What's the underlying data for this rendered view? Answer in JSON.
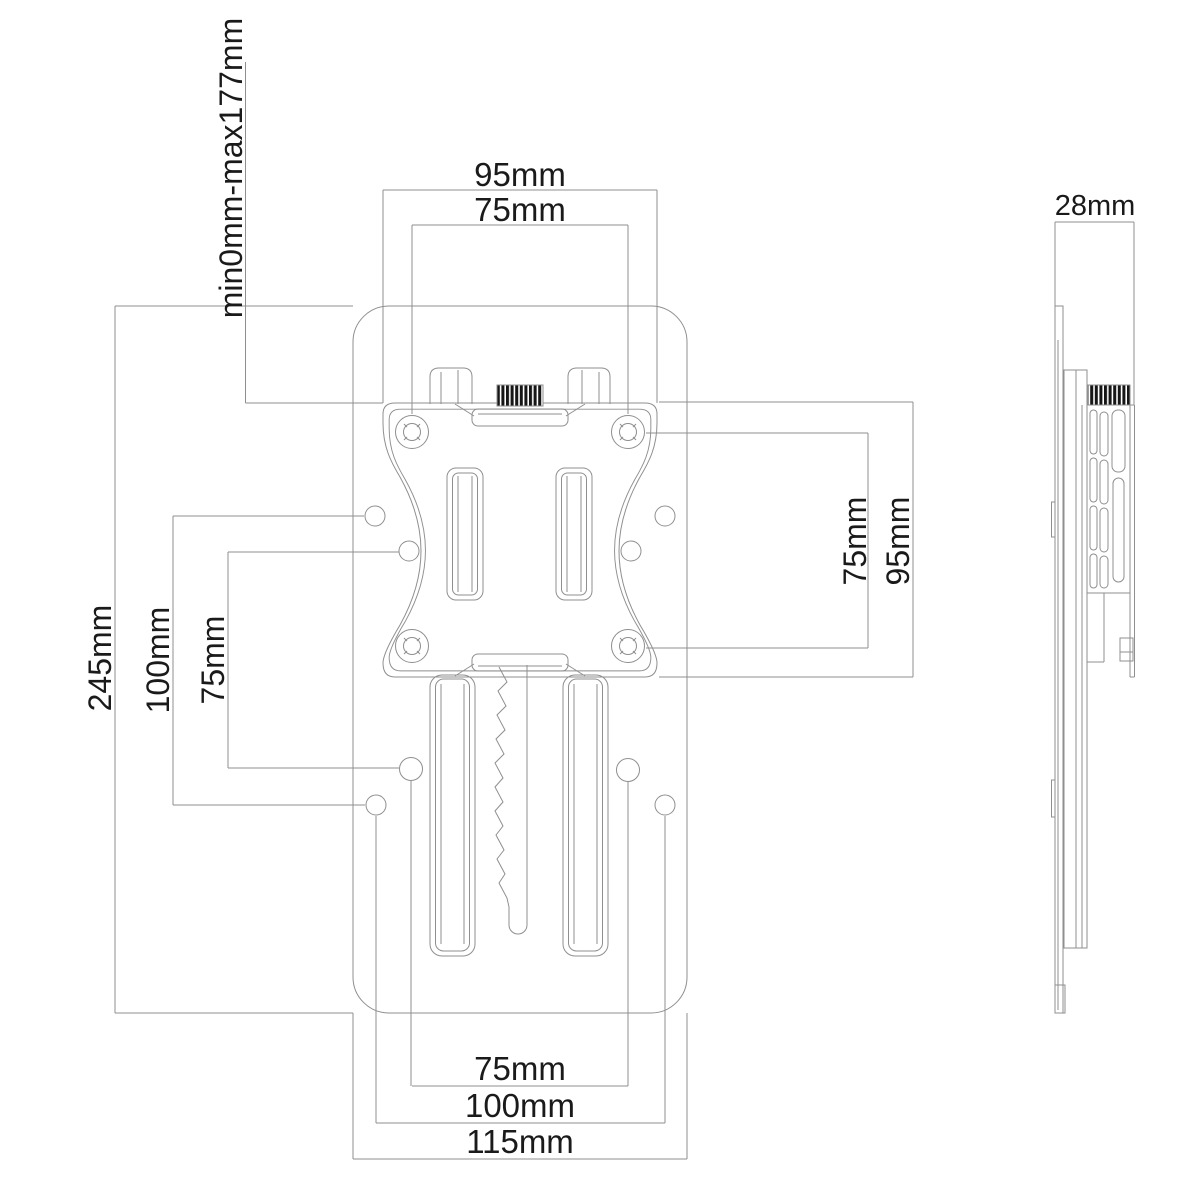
{
  "drawing": {
    "labels": {
      "top_outer": "95mm",
      "top_inner": "75mm",
      "travel_range": "min0mm-max177mm",
      "left_outer": "245mm",
      "left_mid": "100mm",
      "left_inner": "75mm",
      "right_inner": "75mm",
      "right_outer": "95mm",
      "side_depth": "28mm",
      "bottom_inner": "75mm",
      "bottom_mid": "100mm",
      "bottom_outer": "115mm"
    },
    "colors": {
      "background": "#ffffff",
      "line": "#8f8f8f",
      "text": "#1a1a1a",
      "knob_fill": "#161616"
    }
  }
}
